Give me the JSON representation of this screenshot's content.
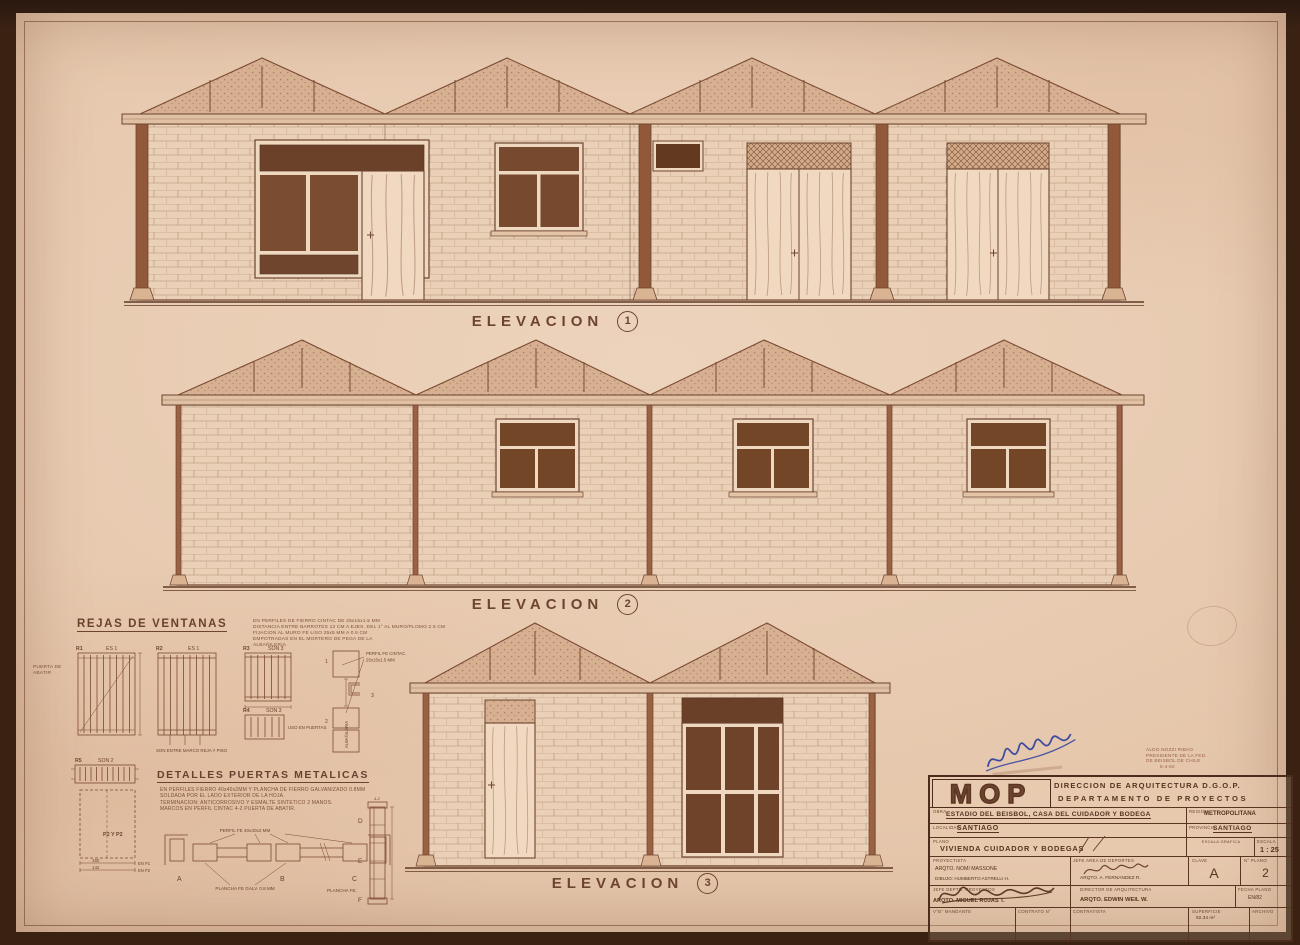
{
  "colors": {
    "paper": "#e5c6ab",
    "ink": "#6d4430",
    "dark_fill": "#74492f",
    "frame_dark": "#4c2d1c",
    "signature_blue": "#2c3fa0"
  },
  "elevation_labels": [
    {
      "text": "ELEVACION",
      "num": "1"
    },
    {
      "text": "ELEVACION",
      "num": "2"
    },
    {
      "text": "ELEVACION",
      "num": "3"
    }
  ],
  "rejas": {
    "title": "REJAS DE VENTANAS",
    "notes": [
      "EN PERFILES DE FIERRO CINTAC DE 25x15x1.5 MM",
      "DISTANCIA ENTRE BARROTES 12 CM A EJES. DEL 1° AL MURO/PLOMO 2.5 CM",
      "FIJACION AL MURO FE LISO 25x5 MM A 0.5 CM",
      "EMPOTRADAS EN EL MORTERO DE PEGA DE LA",
      "ALBAÑILERIA"
    ],
    "puerta_abatir": "PUERTA DE ABATIR",
    "r1": {
      "id": "R1",
      "qty": "ES 1"
    },
    "r2": {
      "id": "R2",
      "qty": "ES 1",
      "note": "SON ENTRE MARCO REJA Y PISO"
    },
    "r3": {
      "id": "R3",
      "qty": "SON 3"
    },
    "r4": {
      "id": "R4",
      "qty": "SON 3",
      "note": "USO EN PUERTAS"
    },
    "r5": {
      "id": "R5",
      "qty": "SON 2"
    },
    "profile": {
      "n1": "1",
      "n2": "2",
      "n3": "3",
      "label1": "PERFIL FE CINTAC",
      "label2": "25x15x1.5 MM",
      "vertical": "ALBAÑILERIA"
    }
  },
  "puertas": {
    "title": "DETALLES PUERTAS METALICAS",
    "notes": [
      "EN PERFILES FIERRO 40x40x2MM Y PLANCHA DE FIERRO GALVANIZADO 0.8MM",
      "SOLDADA POR EL LADO EXTERIOR DE LA HOJA.",
      "TERMINACION: ANTICORROSIVO Y ESMALTE SINTETICO 2 MANOS.",
      "MARCOS EN PERFIL CINTAC 4-2 PUERTA DE ABATIR."
    ],
    "p2": "P2 Y P2",
    "dim1": "160",
    "dim1_note": "EN P1",
    "dim2": "142",
    "dim2_note": "EN P2",
    "perfil": "PERFIL FE 40x40x2 MM",
    "plancha": "PLANCHA FE GALV. 0.8 MM",
    "plancha_fe": "PLANCHA FE.",
    "mark": "4-2",
    "a": "A",
    "b": "B",
    "c": "C",
    "d": "D",
    "e": "E",
    "f": "F"
  },
  "stamp": {
    "l1": "ALDO NOZZI RIBAO",
    "l2": "PRESIDENTE DE LA FED.",
    "l3": "DE BEISBOL DE CHILE",
    "l4": "6-4-82"
  },
  "titleblock": {
    "logo": "MOP",
    "org1": "DIRECCION DE ARQUITECTURA D.G.O.P.",
    "org2": "DEPARTAMENTO DE PROYECTOS",
    "obra_label": "OBRA",
    "obra": "ESTADIO DEL BEISBOL, CASA DEL CUIDADOR Y BODEGA",
    "region_label": "REGION",
    "region": "METROPOLITANA",
    "localidad_label": "LOCALIDAD",
    "localidad": "SANTIAGO",
    "provincia_label": "PROVINCIA",
    "provincia": "SANTIAGO",
    "plano_label": "PLANO",
    "plano": "VIVIENDA CUIDADOR Y BODEGAS",
    "escala_grafica_label": "ESCALA GRAFICA",
    "escala_label": "ESCALA",
    "escala": "1 : 25",
    "proyectista_label": "PROYECTISTA",
    "proyectista": "ARQTO. NOMI MASSONE",
    "dibujo": "DIBUJO: HUMBERTO ASTRELLI H.",
    "jefe_area_label": "JEFE AREA DE DEPORTES",
    "fernandez": "ARQTO. A. FERNANDEZ R.",
    "clave_label": "CLAVE",
    "clave": "A",
    "nplano_label": "N° PLANO",
    "nplano": "2",
    "jefe_depto_label": "JEFE DEPTO. PROYECTOS",
    "rojas": "ARQTO. MIGUEL ROJAS T.",
    "director_label": "DIRECTOR DE ARQUITECTURA",
    "weil": "ARQTO. EDWIN WEIL W.",
    "fecha_label": "FECHA PLANO",
    "fecha": "EN/82",
    "vb_label": "V°B° MANDANTE",
    "contrato_label": "CONTRATO N°",
    "contratista_label": "CONTRATISTA",
    "superficie_label": "SUPERFICIE",
    "superficie": "92.34 m²",
    "archivo_label": "ARCHIVO"
  }
}
